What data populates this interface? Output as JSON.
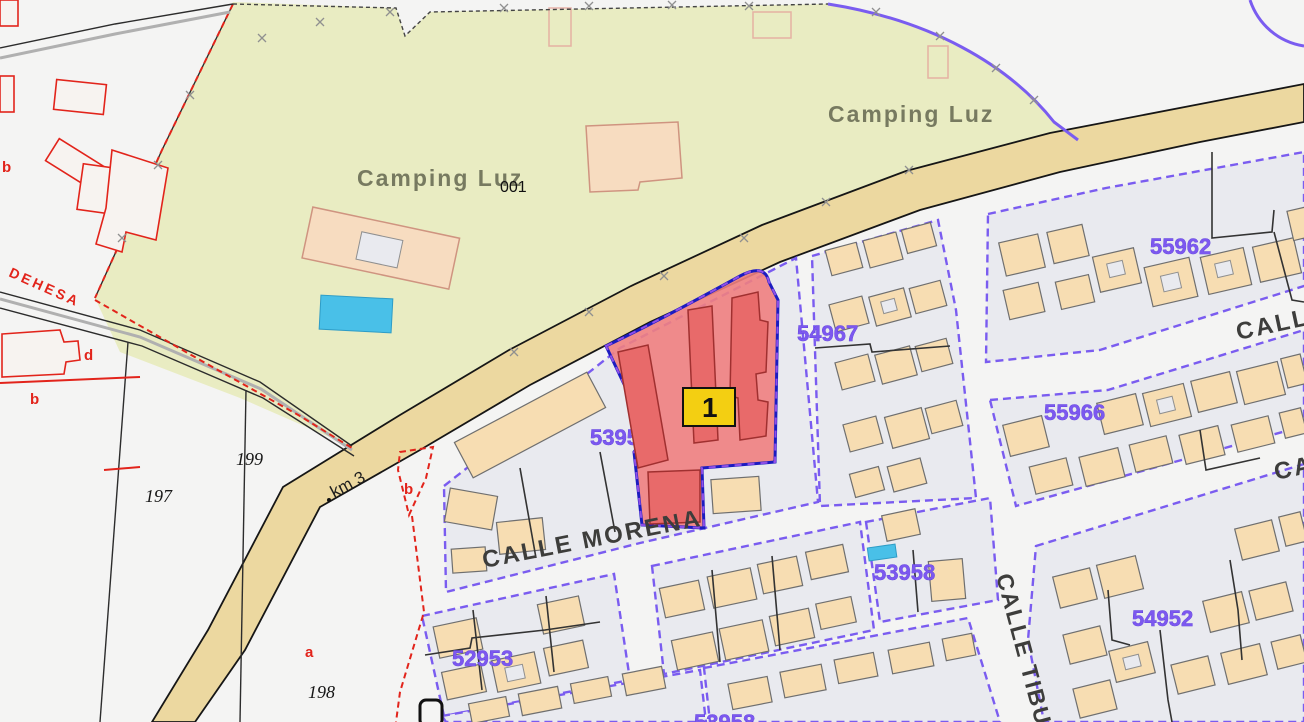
{
  "labels": {
    "camping_top": "Camping Luz",
    "camping_mid": "Camping Luz",
    "camping_code": "001",
    "dehesa": "DEHESA",
    "km_marker": "km 3",
    "parcel_197": "197",
    "parcel_198": "198",
    "parcel_199": "199",
    "sub_a": "a",
    "sub_b_road": "b",
    "sub_b_left": "b",
    "sub_d": "d",
    "selection_badge": "1"
  },
  "parcel_numbers": {
    "n53953": "53953",
    "n54967": "54967",
    "n55962": "55962",
    "n55966": "55966",
    "n53958": "53958",
    "n54952": "54952",
    "n52953": "52953",
    "n_bottom_partial": "53958"
  },
  "streets": {
    "morena": "CALLE MORENA",
    "tibu": "CALLE TIBU",
    "call_upper_partial": "CALL",
    "ca_right_partial": "CA"
  },
  "colors": {
    "background": "#f4f4f3",
    "block_fill": "#e9eaef",
    "boundary_purple": "#7a5cf0",
    "road_fill": "#ecd8a0",
    "camping_fill": "#e9ecc2",
    "building_fill": "#f7ddb2",
    "building_stroke": "#6f6f6f",
    "selection_fill": "#ef8080",
    "selection_building": "#e86a6a",
    "selection_border": "#1c1cc0",
    "badge_bg": "#f3cf12",
    "badge_text": "#111111",
    "parcel_number_color": "#7c58ef",
    "red_boundary": "#e2241b",
    "street_label_color": "#3d3d3b",
    "camping_label_color": "#6e7158",
    "pool_fill": "#49c0e8"
  }
}
